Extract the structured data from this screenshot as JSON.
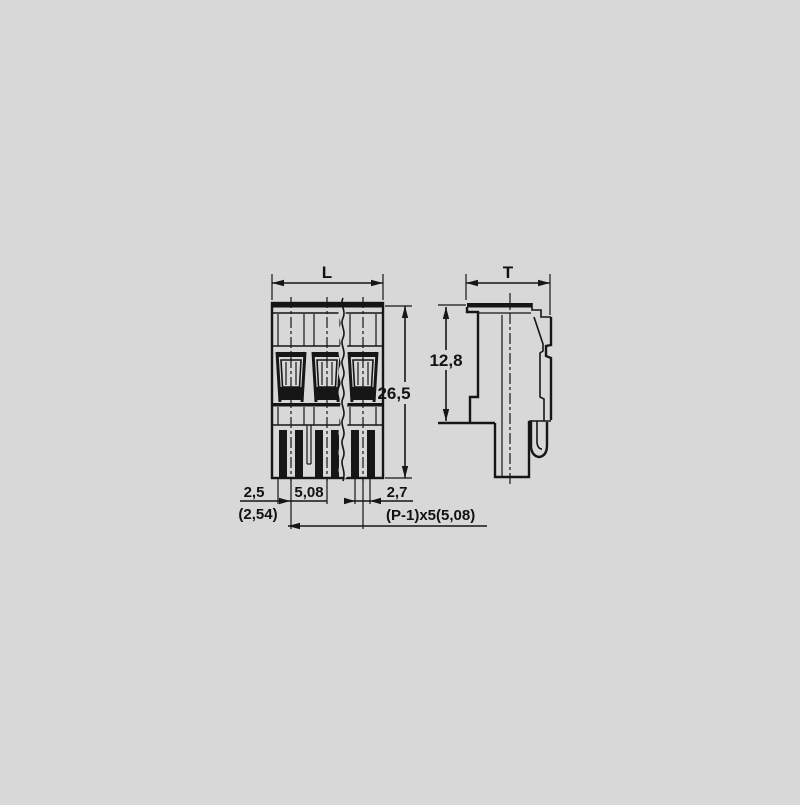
{
  "page": {
    "background_color": "#d8d8d8",
    "line_color": "#161616"
  },
  "front_view": {
    "labels": {
      "width": "L",
      "height": "26,5",
      "edge_to_first_pin": "2,5",
      "edge_to_first_pin_alt": "(2,54)",
      "pin_pitch": "5,08",
      "pin_width": "2,7",
      "total_pitch_formula": "(P-1)x5(5,08)"
    }
  },
  "side_view": {
    "labels": {
      "depth": "T",
      "upper_body_height": "12,8"
    }
  }
}
